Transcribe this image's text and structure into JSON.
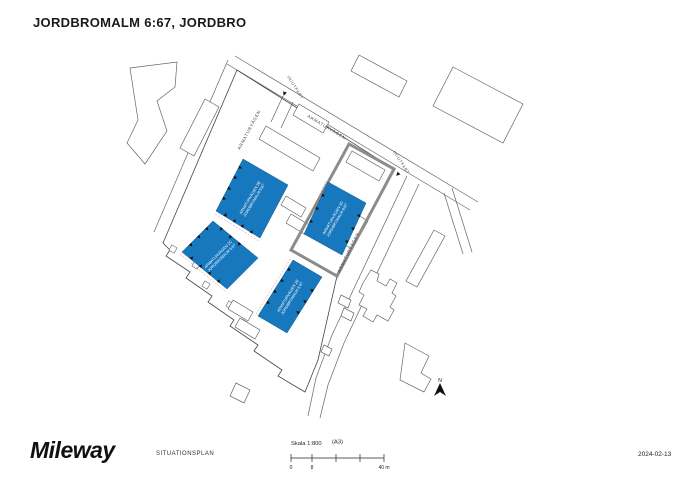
{
  "title": "JORDBROMALM 6:67, JORDBRO",
  "footer": {
    "logo": "Mileway",
    "drawing_type": "SITUATIONSPLAN",
    "date": "2024-02-13"
  },
  "scale_bar": {
    "label": "Skala 1:800",
    "paper_size": "(A3)",
    "tick_zero": "0",
    "tick_eight": "8",
    "tick_end": "40 m"
  },
  "map": {
    "streets": {
      "armaturvagen_top": "ARMATURVÄGEN",
      "armaturvagen_left": "ARMATURVÄGEN",
      "armaturvagen_right": "ARMATURVÄGEN"
    },
    "entrances": {
      "top": "IN/UTFART",
      "right": "IN/UTFART"
    },
    "north_label": "N",
    "buildings": [
      {
        "line1": "ARMATURVÄGEN 2B",
        "line2": "JORDBROMALM 6:67"
      },
      {
        "line1": "ARMATURVÄGEN 2C",
        "line2": "JORDBROMALM 6:67"
      },
      {
        "line1": "ARMATURVÄGEN 2E",
        "line2": "JORDBROMALM 6:67"
      },
      {
        "line1": "ARMATURVÄGEN 2D",
        "line2": "JORDBROMALM 6:67"
      }
    ],
    "colors": {
      "building_fill": "#1878BE",
      "highlight_outline": "#8C8C8C",
      "line": "#555555"
    }
  }
}
